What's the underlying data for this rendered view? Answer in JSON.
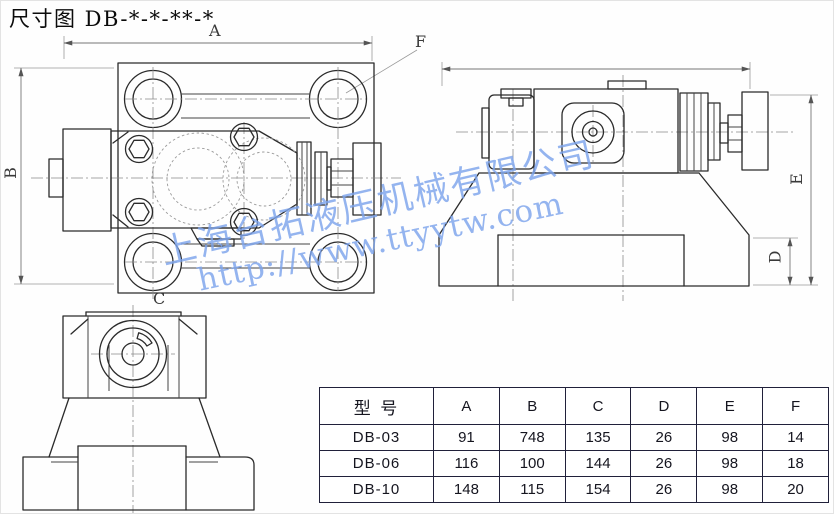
{
  "title": "尺寸图 DB-*-*-**-*",
  "watermark": {
    "company_line": "上海台拓液压机械有限公司",
    "url_line": "http://www.ttyytw.com",
    "color": "#7da4ec"
  },
  "dims": {
    "a": "A",
    "b": "B",
    "c": "C",
    "d": "D",
    "e": "E",
    "f": "F"
  },
  "table": {
    "model_header": "型 号",
    "columns": [
      "A",
      "B",
      "C",
      "D",
      "E",
      "F"
    ],
    "rows": [
      {
        "model": "DB-03",
        "values": [
          "91",
          "748",
          "135",
          "26",
          "98",
          "14"
        ]
      },
      {
        "model": "DB-06",
        "values": [
          "116",
          "100",
          "144",
          "26",
          "98",
          "18"
        ]
      },
      {
        "model": "DB-10",
        "values": [
          "148",
          "115",
          "154",
          "26",
          "98",
          "20"
        ]
      }
    ]
  }
}
